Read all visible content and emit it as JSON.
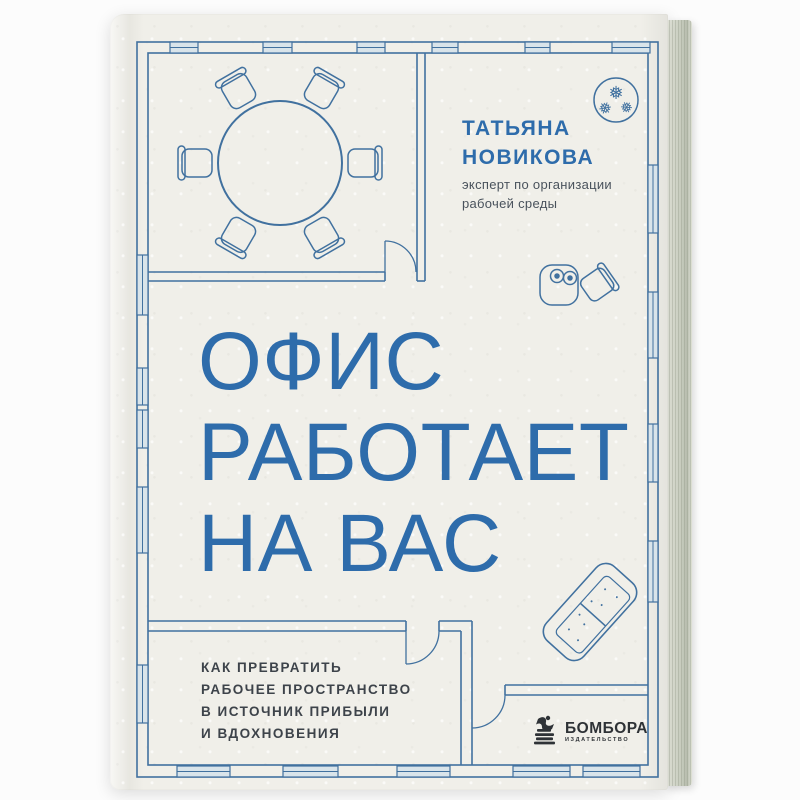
{
  "book": {
    "author": {
      "name_line1": "ТАТЬЯНА",
      "name_line2": "НОВИКОВА",
      "role_line1": "эксперт по организации",
      "role_line2": "рабочей среды"
    },
    "title": {
      "line1": "ОФИС",
      "line2": "РАБОТАЕТ",
      "line3": "НА ВАС"
    },
    "subtitle_lines": [
      "КАК ПРЕВРАТИТЬ",
      "РАБОЧЕЕ ПРОСТРАНСТВО",
      "В ИСТОЧНИК ПРИБЫЛИ",
      "И ВДОХНОВЕНИЯ"
    ],
    "publisher": {
      "name": "БОМБОРА",
      "tagline": "ИЗДАТЕЛЬСТВО"
    },
    "colors": {
      "cover_paper": "#f0efe9",
      "plan_line_blue": "#41719f",
      "window_fill": "#d9e4ea",
      "title_blue": "#2e6cab",
      "role_text": "#49525c",
      "subtitle_text": "#3d434a",
      "logo_dark": "#2e3236"
    },
    "floor_plan": {
      "icons": [
        "meeting-table-icon",
        "chair-icon",
        "plant-icon",
        "coffee-table-icon",
        "coffee-chair-icon",
        "sofa-icon",
        "door-icon",
        "window-icon"
      ],
      "plant_leaf_glyph": "❅"
    }
  }
}
